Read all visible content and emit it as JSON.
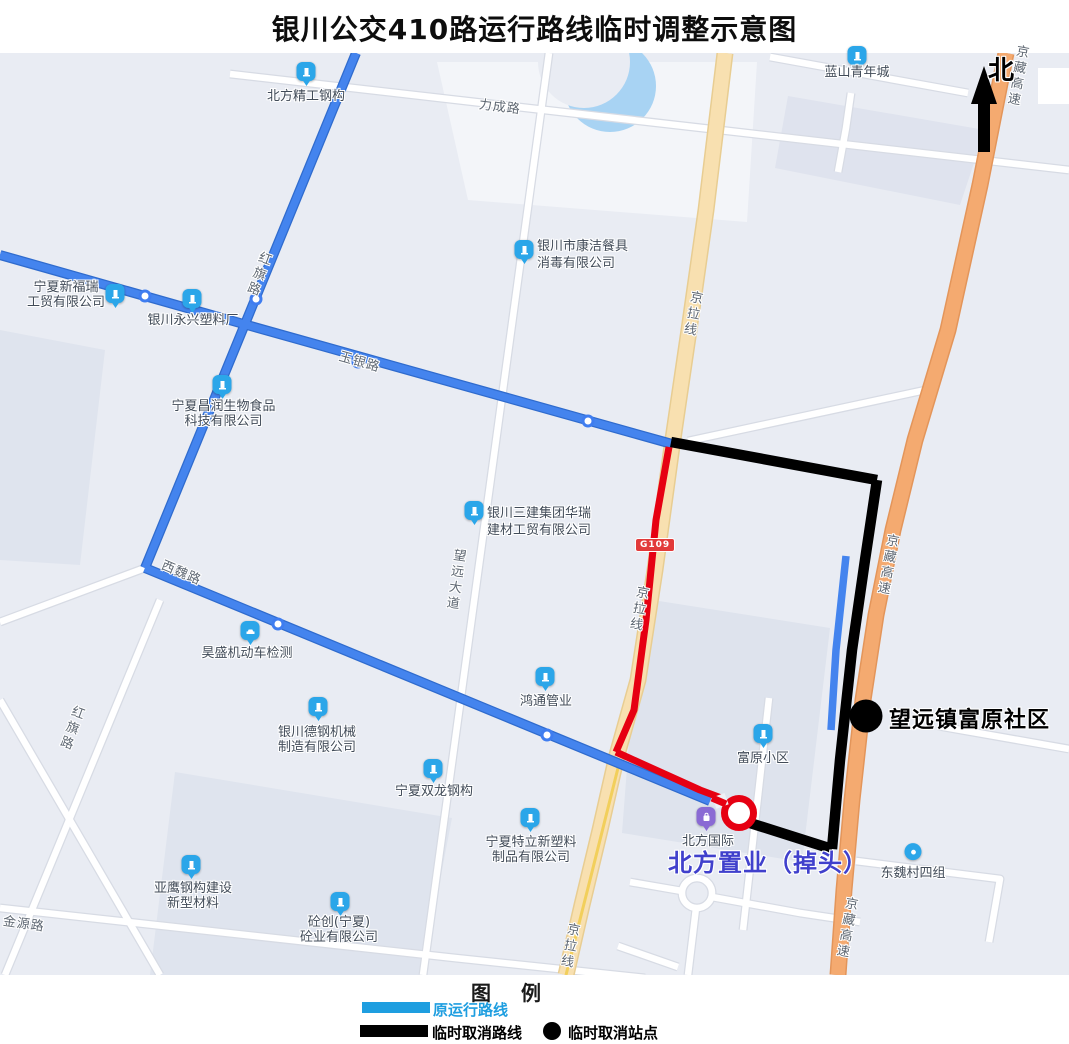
{
  "title": "银川公交410路运行路线临时调整示意图",
  "compass": {
    "north_label": "北"
  },
  "legend": {
    "heading_left": "图",
    "heading_right": "例",
    "original_route_label": "原运行路线",
    "cancelled_route_label": "临时取消路线",
    "cancelled_stop_label": "临时取消站点"
  },
  "colors": {
    "original_route": "#4484ee",
    "legend_original_route": "#1e9ee0",
    "cancelled_route": "#000000",
    "temp_adjusted_route": "#e60012",
    "expressway_fill": "#f4aa70",
    "g109_road_fill": "#f8e0b0",
    "uturn_text": "#4040cc"
  },
  "roads": {
    "licheng": "力成路",
    "hongqi": "红旗路",
    "yuyin": "玉银路",
    "xiwei": "西魏路",
    "wangyuan_avenue": "望远大道",
    "jingla": "京拉线",
    "jingzang": "京藏高速",
    "jinyuan": "金源路",
    "g109_badge": "G109"
  },
  "annotations": {
    "cancelled_stop": "望远镇富原社区",
    "uturn": "北方置业（掉头）"
  },
  "pois": [
    {
      "name": "北方精工钢构",
      "icon": "building-icon",
      "lines": [
        "北方精工钢构"
      ]
    },
    {
      "name": "蓝山青年城",
      "icon": "building-icon",
      "lines": [
        "蓝山青年城"
      ]
    },
    {
      "name": "银川市康洁餐具消毒有限公司",
      "icon": "building-icon",
      "lines": [
        "银川市康洁餐具",
        "消毒有限公司"
      ]
    },
    {
      "name": "宁夏新福瑞工贸有限公司",
      "icon": "building-icon",
      "lines": [
        "宁夏新福瑞",
        "工贸有限公司"
      ]
    },
    {
      "name": "银川永兴塑料厂",
      "icon": "building-icon",
      "lines": [
        "银川永兴塑料厂"
      ]
    },
    {
      "name": "宁夏昌润生物食品科技有限公司",
      "icon": "building-icon",
      "lines": [
        "宁夏昌润生物食品",
        "科技有限公司"
      ]
    },
    {
      "name": "银川三建集团华瑞建材工贸有限公司",
      "icon": "building-icon",
      "lines": [
        "银川三建集团华瑞",
        "建材工贸有限公司"
      ]
    },
    {
      "name": "昊盛机动车检测",
      "icon": "car-icon",
      "lines": [
        "昊盛机动车检测"
      ]
    },
    {
      "name": "银川德钢机械制造有限公司",
      "icon": "building-icon",
      "lines": [
        "银川德钢机械",
        "制造有限公司"
      ]
    },
    {
      "name": "鸿通管业",
      "icon": "building-icon",
      "lines": [
        "鸿通管业"
      ]
    },
    {
      "name": "宁夏双龙钢构",
      "icon": "building-icon",
      "lines": [
        "宁夏双龙钢构"
      ]
    },
    {
      "name": "宁夏特立新塑料制品有限公司",
      "icon": "building-icon",
      "lines": [
        "宁夏特立新塑料",
        "制品有限公司"
      ]
    },
    {
      "name": "亚鹰钢构建设新型材料",
      "icon": "building-icon",
      "lines": [
        "亚鹰钢构建设",
        "新型材料"
      ]
    },
    {
      "name": "砼创(宁夏)砼业有限公司",
      "icon": "building-icon",
      "lines": [
        "砼创(宁夏)",
        "砼业有限公司"
      ]
    },
    {
      "name": "富原小区",
      "icon": "building-icon",
      "lines": [
        "富原小区"
      ]
    },
    {
      "name": "北方国际",
      "icon": "bag-icon",
      "lines": [
        "北方国际"
      ]
    },
    {
      "name": "东魏村四组",
      "icon": "dot-icon",
      "lines": [
        "东魏村四组"
      ]
    }
  ]
}
